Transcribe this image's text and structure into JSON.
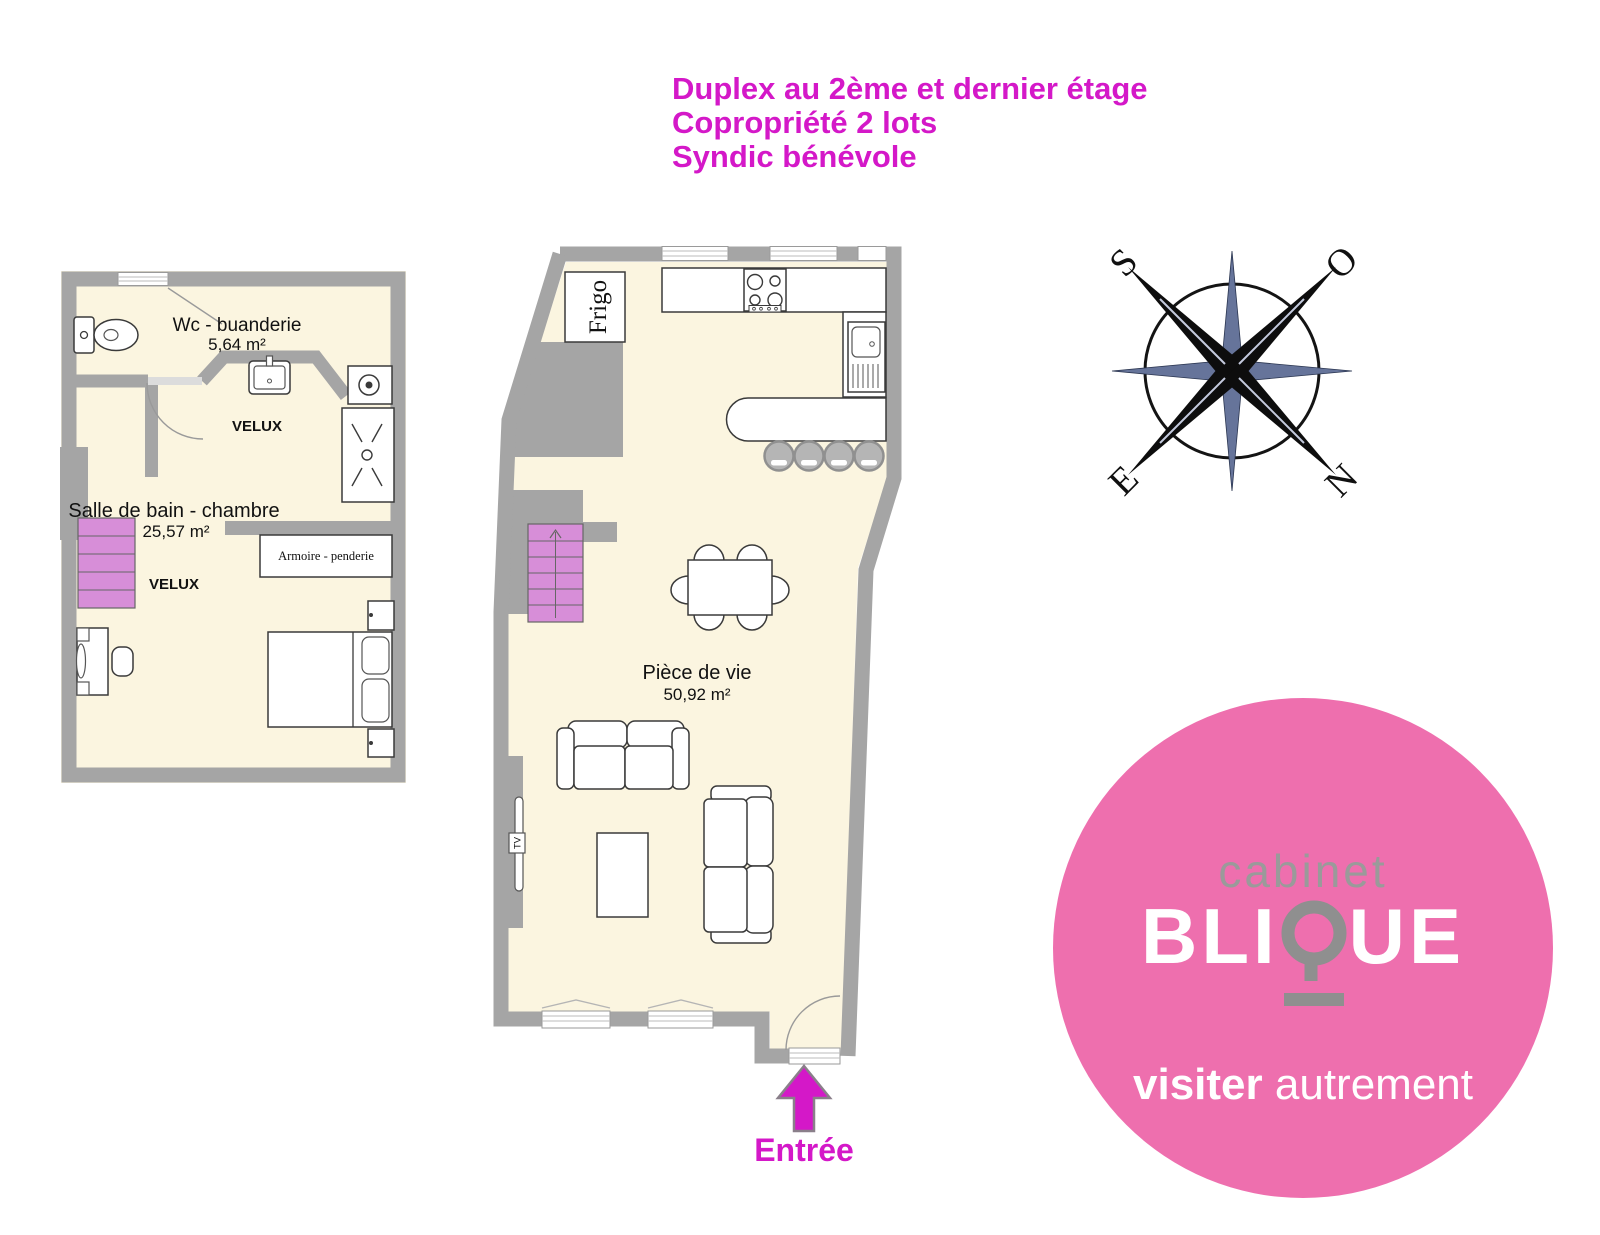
{
  "title": {
    "line1": "Duplex au 2ème et dernier étage",
    "line2": "Copropriété 2 lots",
    "line3": "Syndic bénévole"
  },
  "plan_upper": {
    "room1_name": "Wc - buanderie",
    "room1_area": "5,64 m²",
    "velux_upper": "VELUX",
    "room2_name": "Salle de bain - chambre",
    "room2_area": "25,57 m²",
    "velux_lower": "VELUX",
    "wardrobe_label": "Armoire - penderie"
  },
  "plan_main": {
    "fridge_label": "Frigo",
    "room_name": "Pièce de vie",
    "room_area": "50,92 m²",
    "tv_label": "TV",
    "entrance_label": "Entrée"
  },
  "compass": {
    "south_label": "S",
    "west_label": "O",
    "east_label": "E",
    "north_label": "N"
  },
  "logo": {
    "line_top": "cabinet",
    "name_prefix": "BLI",
    "name_suffix": "UE",
    "tagline_bold": "visiter",
    "tagline_light": "autrement"
  },
  "colors": {
    "accent_magenta": "#d418c8",
    "logo_pink": "#ee6fae",
    "wall_gray": "#a5a5a5",
    "floor_cream": "#fbf5e0",
    "stairs_pink": "#d78ed8",
    "compass_slate": "#66749a"
  }
}
